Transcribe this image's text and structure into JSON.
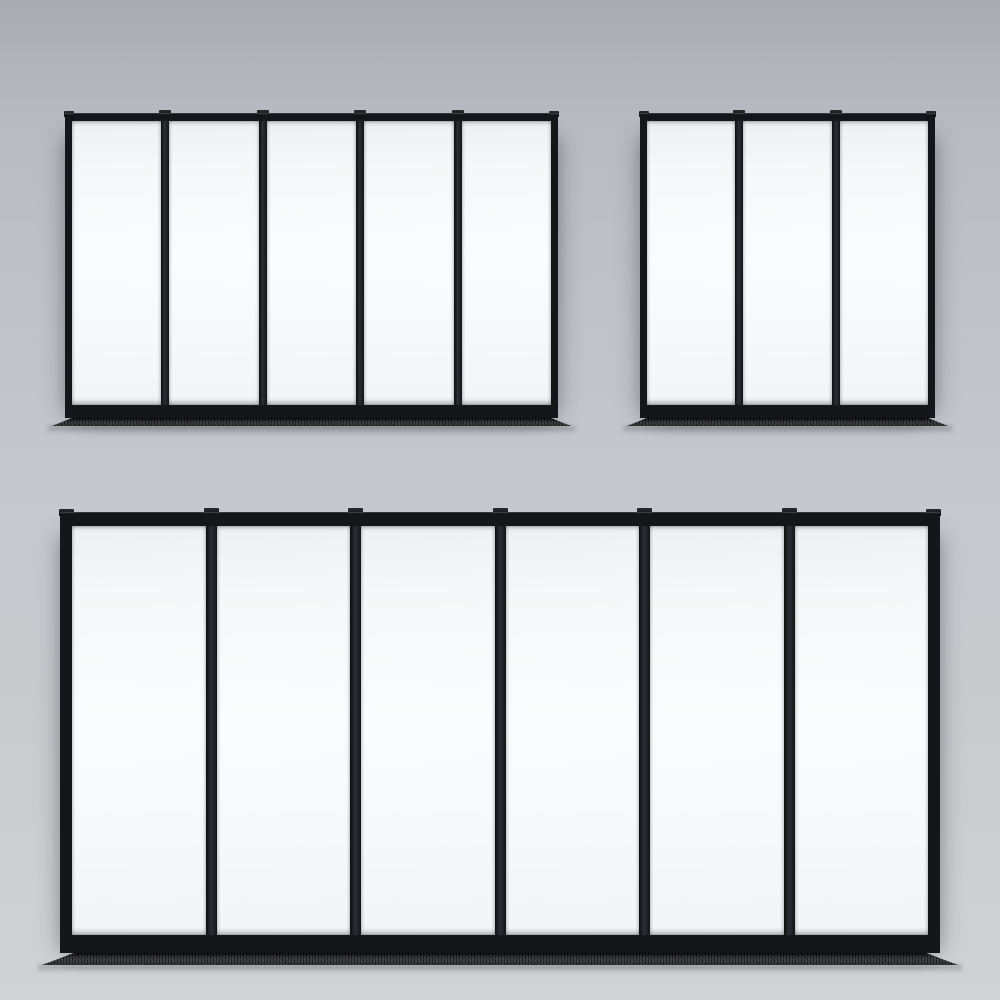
{
  "scene": {
    "description": "3D render of three black steel-framed glass partition window units mounted on a light gray wall",
    "units_count": 3,
    "colors": {
      "background_top": "#b1b4ba",
      "background_bottom": "#d0d2d5",
      "frame_black": "#141619",
      "mullion_highlight": "#2b2e33",
      "glass_white": "#f7f9fa",
      "floor_track_dark": "#2e3032"
    }
  },
  "windows": [
    {
      "id": "top-left",
      "label": "5-panel glass partition",
      "panels": 5,
      "x": 65,
      "y": 113,
      "width": 493,
      "height": 305,
      "profile": {
        "top_rail": 8,
        "bottom_rail": 13,
        "stile": 7,
        "mullion": 8,
        "cap_height": 3,
        "track_height": 8,
        "track_overhang": 13,
        "track_slant": 20
      }
    },
    {
      "id": "top-right",
      "label": "3-panel glass partition",
      "panels": 3,
      "x": 640,
      "y": 113,
      "width": 295,
      "height": 305,
      "profile": {
        "top_rail": 8,
        "bottom_rail": 13,
        "stile": 7,
        "mullion": 8,
        "cap_height": 3,
        "track_height": 8,
        "track_overhang": 13,
        "track_slant": 20
      }
    },
    {
      "id": "bottom",
      "label": "6-panel glass partition",
      "panels": 6,
      "x": 60,
      "y": 512,
      "width": 880,
      "height": 441,
      "profile": {
        "top_rail": 14,
        "bottom_rail": 18,
        "stile": 12,
        "mullion": 11,
        "cap_height": 4,
        "track_height": 12,
        "track_overhang": 18,
        "track_slant": 32
      }
    }
  ]
}
